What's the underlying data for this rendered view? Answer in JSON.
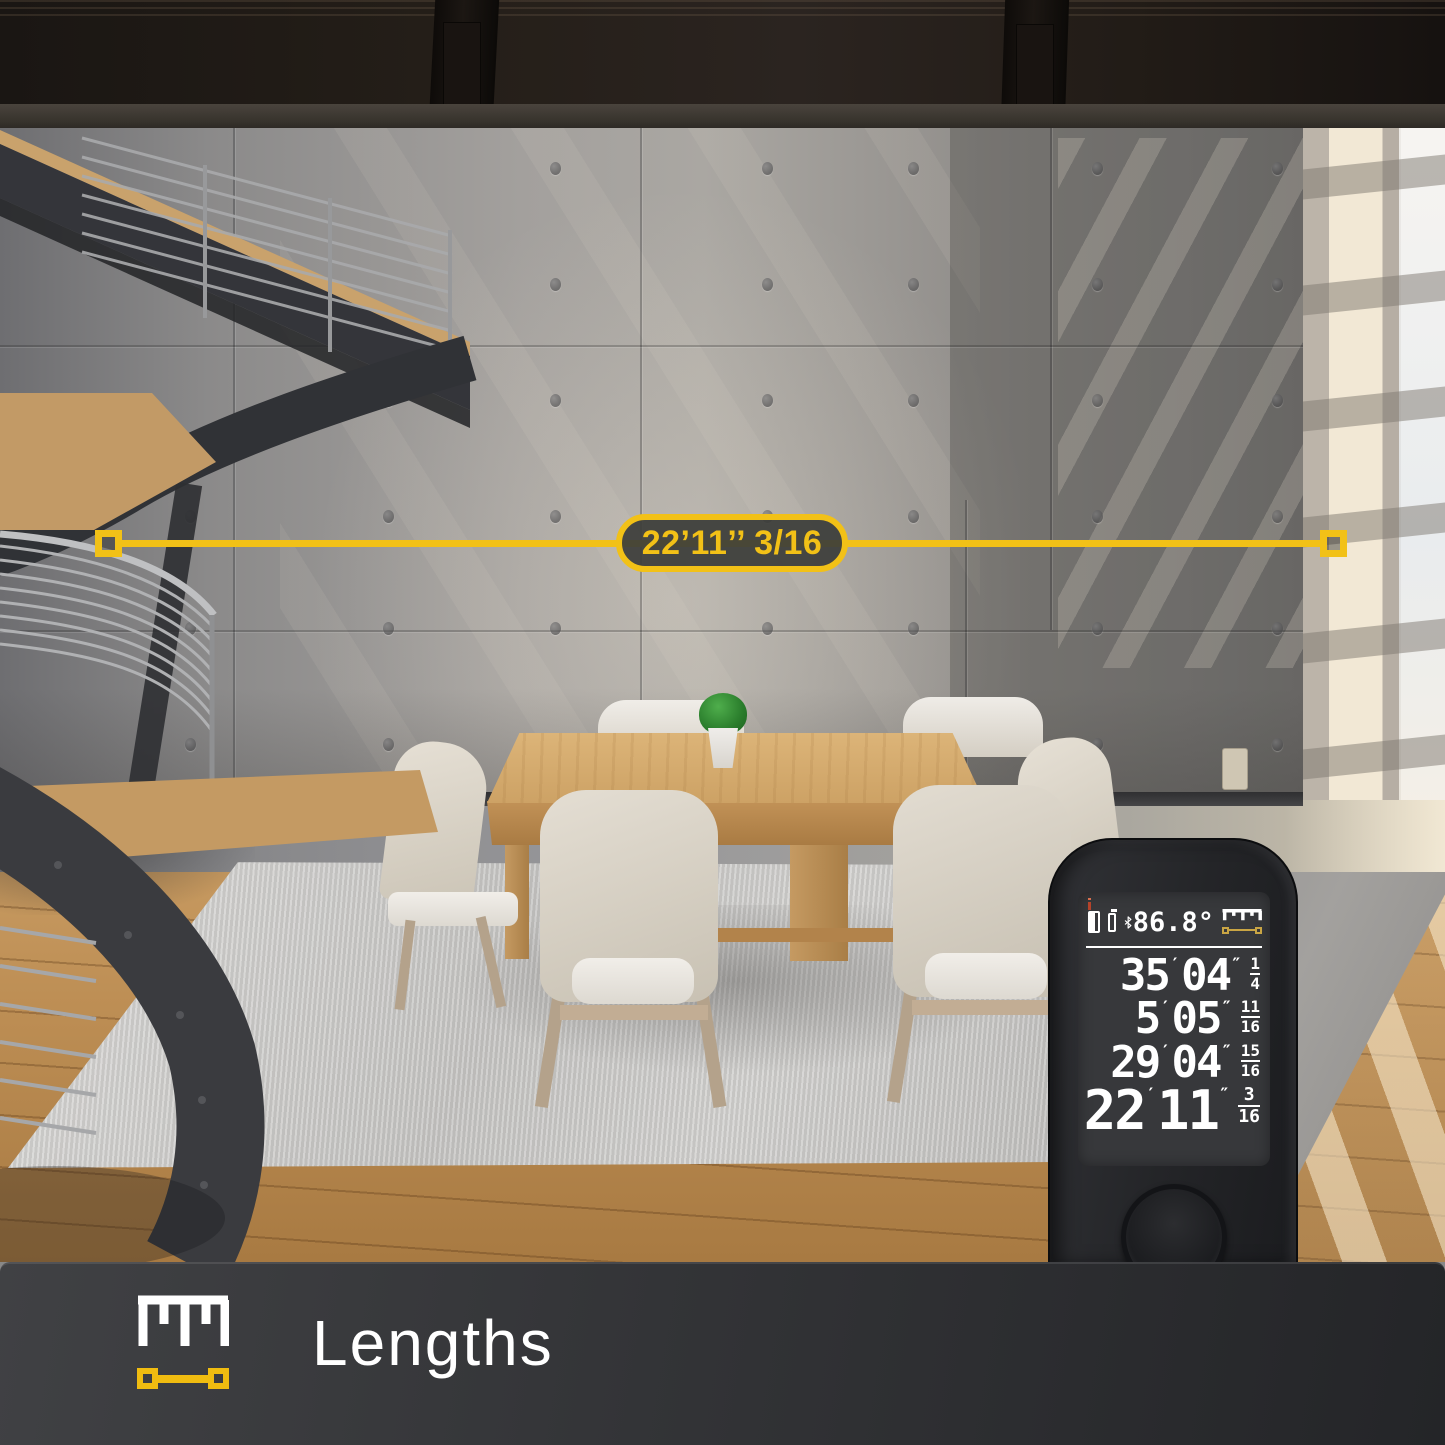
{
  "measurement_overlay": {
    "label": "22’11’’ 3/16"
  },
  "device": {
    "status": {
      "angle": "86.8°"
    },
    "units": {
      "feet_mark": "′",
      "inch_mark": "″"
    },
    "readings": [
      {
        "feet": "35",
        "inches": "04",
        "frac_num": "1",
        "frac_den": "4"
      },
      {
        "feet": "5",
        "inches": "05",
        "frac_num": "11",
        "frac_den": "16"
      },
      {
        "feet": "29",
        "inches": "04",
        "frac_num": "15",
        "frac_den": "16"
      }
    ],
    "current": {
      "feet": "22",
      "inches": "11",
      "frac_num": "3",
      "frac_den": "16"
    }
  },
  "footer": {
    "label": "Lengths"
  },
  "icons": {
    "device_status": [
      "laser-device-icon",
      "battery-icon",
      "bluetooth-icon",
      "ruler-scale-icon",
      "measure-line-icon"
    ],
    "footer": [
      "ruler-scale-icon",
      "measure-line-icon"
    ]
  },
  "colors": {
    "accent_yellow": "#F2C117",
    "footer_yellow": "#F0BC10",
    "display_gold": "#C9A544"
  }
}
